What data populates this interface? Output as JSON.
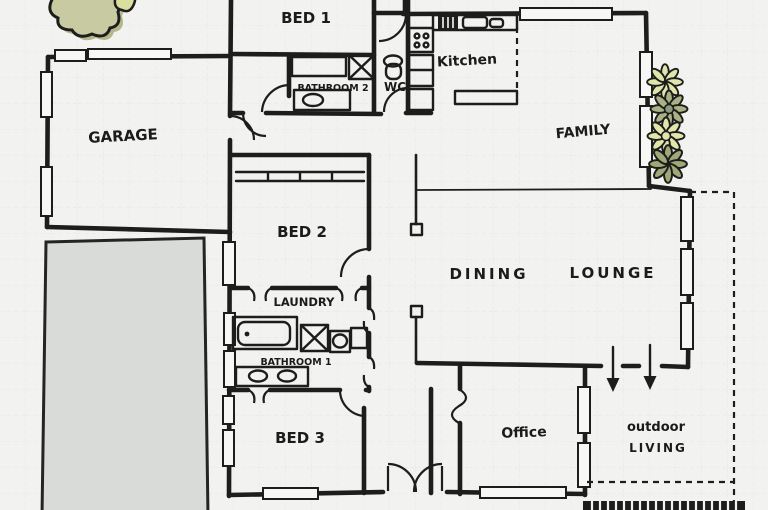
{
  "figure": {
    "type": "hand-drawn residential floor plan"
  },
  "rooms": {
    "bed1": {
      "label": "BED 1"
    },
    "bathroom2": {
      "label": "BATHROOM 2"
    },
    "wc": {
      "label": "WC"
    },
    "kitchen": {
      "label": "Kitchen"
    },
    "family": {
      "label": "FAMILY"
    },
    "garage": {
      "label": "GARAGE"
    },
    "bed2": {
      "label": "BED 2"
    },
    "dining": {
      "label": "DINING"
    },
    "lounge": {
      "label": "LOUNGE"
    },
    "laundry": {
      "label": "LAUNDRY"
    },
    "bathroom1": {
      "label": "BATHROOM 1"
    },
    "bed3": {
      "label": "BED 3"
    },
    "office": {
      "label": "Office"
    },
    "outdoor_living": {
      "line1": "outdoor",
      "line2": "LIVING"
    }
  },
  "fixtures": [
    "toilet",
    "shower",
    "vanity-basin",
    "bath-tub",
    "washing-machine",
    "kitchen-cooktop",
    "kitchen-sink",
    "fridge",
    "built-in-wardrobe",
    "french-doors",
    "door-swing-arc",
    "sliding-door-arrow",
    "deck-boards"
  ],
  "landscape": [
    "tree",
    "flower-bed",
    "driveway"
  ],
  "colors": {
    "ink": "#1d1d1b",
    "paper": "#f2f3f0",
    "grid": "#e5e7e2",
    "driveway": "#d9dbd8",
    "plant_pale": "#dfe5ab",
    "plant_olive": "#a3ac7e",
    "tree": "#c8caa2",
    "tree_shadow": "#b4b78c"
  }
}
